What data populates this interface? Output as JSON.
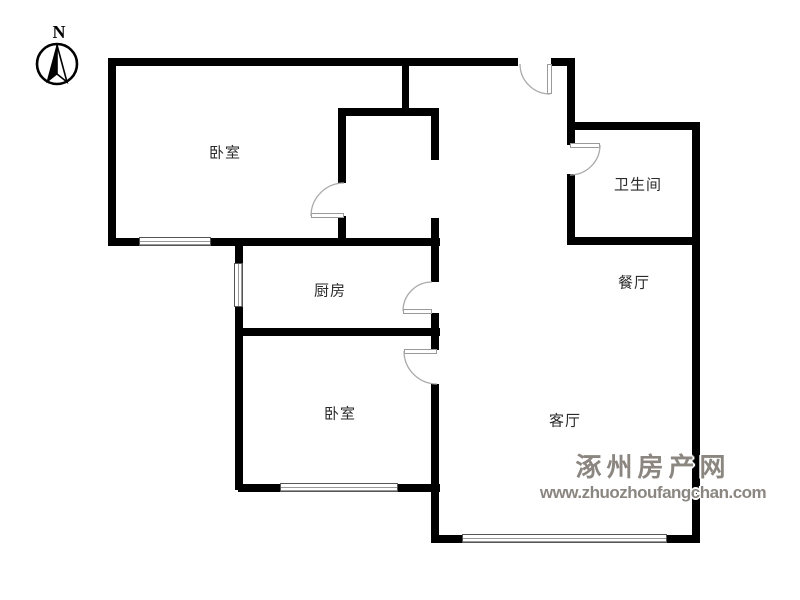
{
  "compass": {
    "label": "N"
  },
  "watermark": {
    "line1": "涿州房产网",
    "line2": "www.zhuozhoufangchan.com",
    "color": "#8b8680"
  },
  "rooms": [
    {
      "id": "bedroom-1",
      "label": "卧室",
      "x": 225,
      "y": 152
    },
    {
      "id": "bathroom",
      "label": "卫生间",
      "x": 638,
      "y": 184
    },
    {
      "id": "kitchen",
      "label": "厨房",
      "x": 330,
      "y": 290
    },
    {
      "id": "dining",
      "label": "餐厅",
      "x": 634,
      "y": 282
    },
    {
      "id": "bedroom-2",
      "label": "卧室",
      "x": 340,
      "y": 413
    },
    {
      "id": "living",
      "label": "客厅",
      "x": 565,
      "y": 420
    }
  ],
  "floorplan": {
    "wall_color": "#000000",
    "walls": [
      {
        "x": 108,
        "y": 58,
        "w": 410,
        "h": 8
      },
      {
        "x": 551,
        "y": 58,
        "w": 24,
        "h": 8
      },
      {
        "x": 567,
        "y": 58,
        "w": 8,
        "h": 72
      },
      {
        "x": 567,
        "y": 122,
        "w": 133,
        "h": 8
      },
      {
        "x": 692,
        "y": 122,
        "w": 8,
        "h": 421
      },
      {
        "x": 402,
        "y": 58,
        "w": 7,
        "h": 58
      },
      {
        "x": 338,
        "y": 108,
        "w": 100,
        "h": 8
      },
      {
        "x": 108,
        "y": 58,
        "w": 8,
        "h": 188
      },
      {
        "x": 108,
        "y": 238,
        "w": 332,
        "h": 8
      },
      {
        "x": 338,
        "y": 108,
        "w": 8,
        "h": 75
      },
      {
        "x": 338,
        "y": 216,
        "w": 8,
        "h": 30
      },
      {
        "x": 431,
        "y": 108,
        "w": 8,
        "h": 52
      },
      {
        "x": 431,
        "y": 218,
        "w": 8,
        "h": 64
      },
      {
        "x": 431,
        "y": 313,
        "w": 8,
        "h": 37
      },
      {
        "x": 431,
        "y": 384,
        "w": 8,
        "h": 159
      },
      {
        "x": 235,
        "y": 238,
        "w": 8,
        "h": 252
      },
      {
        "x": 235,
        "y": 328,
        "w": 205,
        "h": 8
      },
      {
        "x": 238,
        "y": 484,
        "w": 202,
        "h": 8
      },
      {
        "x": 432,
        "y": 535,
        "w": 268,
        "h": 8
      },
      {
        "x": 567,
        "y": 237,
        "w": 133,
        "h": 8
      },
      {
        "x": 567,
        "y": 130,
        "w": 8,
        "h": 15
      },
      {
        "x": 567,
        "y": 174,
        "w": 8,
        "h": 71
      }
    ],
    "windows": [
      {
        "x": 139,
        "y": 237,
        "w": 72,
        "h": 9,
        "orient": "h"
      },
      {
        "x": 234,
        "y": 263,
        "w": 9,
        "h": 44,
        "orient": "v"
      },
      {
        "x": 280,
        "y": 483,
        "w": 118,
        "h": 9,
        "orient": "h"
      },
      {
        "x": 462,
        "y": 534,
        "w": 205,
        "h": 9,
        "orient": "h"
      }
    ],
    "doors": [
      {
        "name": "bedroom-1-door",
        "arc": "M 311 216 A 33 33 0 0 1 344 183",
        "leaf": {
          "x": 311,
          "y": 212.5,
          "w": 33,
          "h": 5
        }
      },
      {
        "name": "entrance-door",
        "arc": "M 520 64 A 30 30 0 0 0 550 94",
        "leaf": {
          "x": 547,
          "y": 64,
          "w": 5,
          "h": 30
        }
      },
      {
        "name": "bathroom-door",
        "arc": "M 600 145 A 30 30 0 0 1 570 175",
        "leaf": {
          "x": 570,
          "y": 142.5,
          "w": 30,
          "h": 5
        }
      },
      {
        "name": "kitchen-door",
        "arc": "M 432 282 A 29 29 0 0 0 403 311",
        "leaf": {
          "x": 403,
          "y": 308.5,
          "w": 29,
          "h": 5
        }
      },
      {
        "name": "bedroom-2-door",
        "arc": "M 404 351 A 33 33 0 0 0 437 384",
        "leaf": {
          "x": 404,
          "y": 348.5,
          "w": 33,
          "h": 5
        }
      }
    ]
  }
}
